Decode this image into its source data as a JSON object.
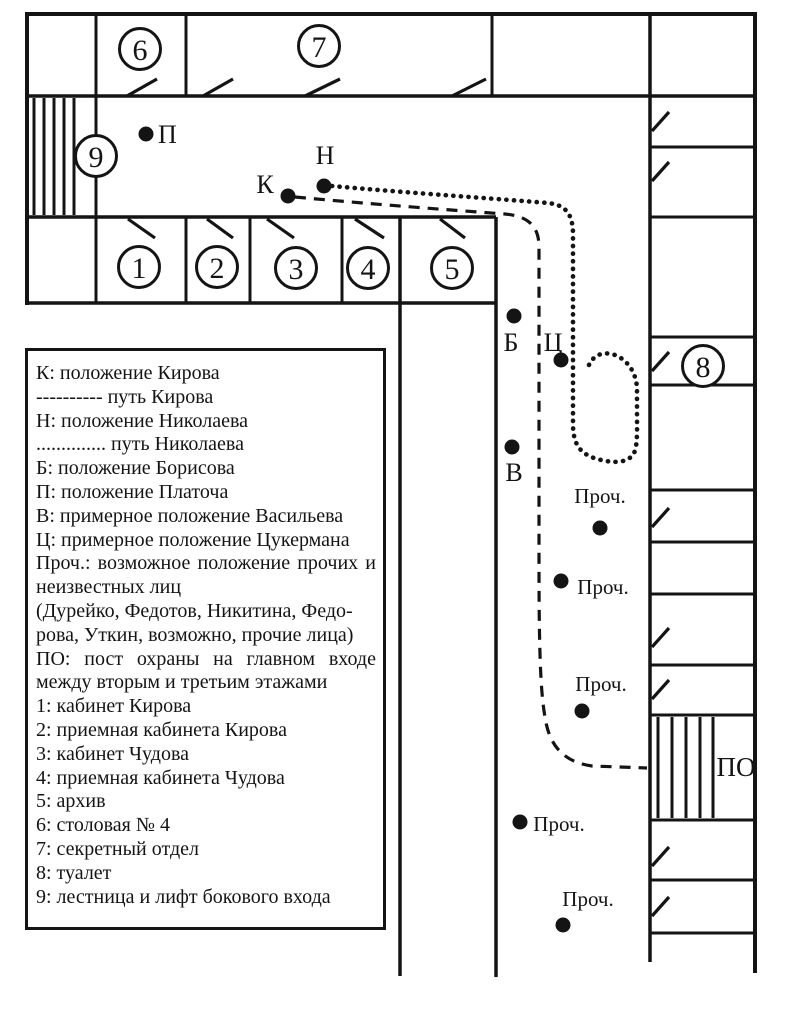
{
  "map": {
    "circled_rooms": {
      "r1": "1",
      "r2": "2",
      "r3": "3",
      "r4": "4",
      "r5": "5",
      "r6": "6",
      "r7": "7",
      "r8": "8",
      "r9": "9"
    },
    "markers": {
      "platoch": "П",
      "kirov": "К",
      "nikolaev": "Н",
      "borisov": "Б",
      "tsukerman": "Ц",
      "vasilev": "В",
      "others": "Проч.",
      "guard_post": "ПО"
    },
    "path_styles": {
      "kirov": "dashed",
      "nikolaev": "dotted"
    },
    "ink_color": "#141414",
    "background_color": "#ffffff"
  },
  "legend": {
    "lines": [
      "К: положение Кирова",
      "---------- путь Кирова",
      "Н: положение Николаева",
      ".............. путь Николаева",
      "Б: положение Борисова",
      "П: положение Платоча",
      "В: примерное положение Васильева",
      "Ц: примерное положение Цукермана",
      "Проч.: возможное положение прочих и",
      "неизвестных лиц",
      "(Дурейко, Федотов, Никитина, Федо-",
      "рова, Уткин, возможно, прочие лица)",
      "ПО: пост охраны на главном входе",
      "между вторым и третьим этажами",
      "1: кабинет Кирова",
      "2: приемная кабинета Кирова",
      "3: кабинет Чудова",
      "4: приемная кабинета Чудова",
      "5: архив",
      "6: столовая № 4",
      "7: секретный отдел",
      "8: туалет",
      "9: лестница и лифт бокового входа"
    ]
  }
}
